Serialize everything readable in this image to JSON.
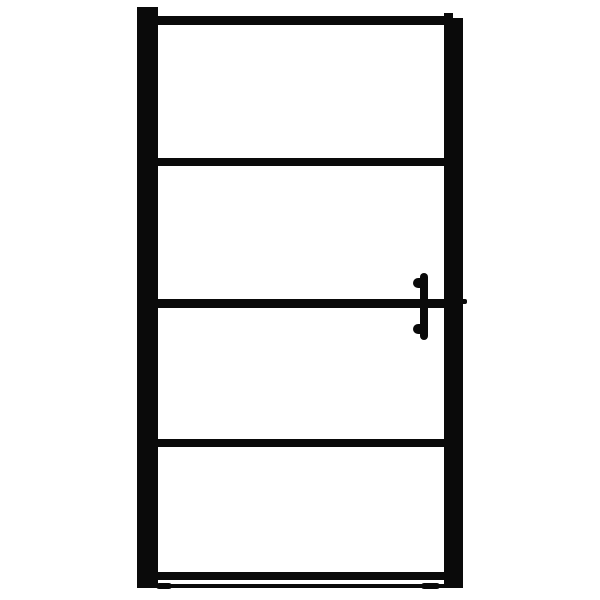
{
  "scene": {
    "type": "product-photo",
    "subject": "Front view of a shower door with matte black frame, four glass panels and a vertical bar handle on the right side",
    "background_color": "#ffffff"
  },
  "door": {
    "frame_color": "#0a0a0a",
    "glass_color": "#ffffff",
    "panel_count": 4,
    "horizontal_rail_count": 5,
    "vertical_post_count": 2,
    "handle": {
      "side": "right",
      "type": "vertical bar handle",
      "color": "#0a0a0a",
      "mount_count": 2
    },
    "bottom_seal": {
      "present": true,
      "color": "#0a0a0a"
    }
  }
}
